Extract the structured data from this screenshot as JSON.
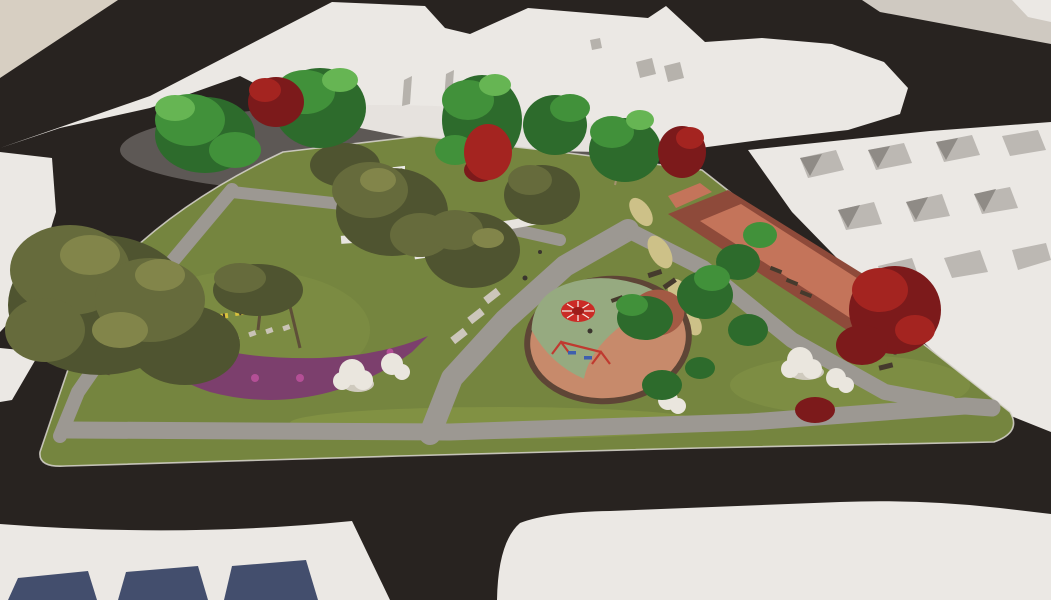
{
  "scene": {
    "type": "architectural-3d-render",
    "view": "aerial-perspective",
    "subject": "Triangular pocket park with circular playground, walkways, fitness track and planting, surrounded by dark asphalt streets, white plaza surfaces and white massing-model row houses",
    "features": [
      "asphalt-roads",
      "white-plazas",
      "beige-corner-lot",
      "row-house-block",
      "roof-courtyards",
      "blue-skylights",
      "park-lawn",
      "perimeter-walkway",
      "central-walkway",
      "circular-playground",
      "playground-carousel",
      "swing-set",
      "fitness-track",
      "ornamental-grass-bed",
      "purple-flower-crescent",
      "stepping-stones",
      "park-benches",
      "white-flowering-shrubs",
      "green-trees",
      "olive-trees",
      "red-maple-trees",
      "soccer-goal",
      "white-garden-walls",
      "pedestrians"
    ]
  },
  "colors": {
    "road": "#282320",
    "beige": "#d7cfc2",
    "plaza": "#ebe8e4",
    "plaza_shade": "#d9d4cf",
    "plaza_warm": "#cfc9c1",
    "furniture": "#b6b2ac",
    "roof_shadow": "#bcb8b3",
    "roof_dark": "#8f8b86",
    "skylight": "#434e6d",
    "grass": "#75853f",
    "grass_light": "#93a24c",
    "curb": "#d9d6cf",
    "path": "#9c9892",
    "track_dark": "#8e4a3a",
    "track_light": "#c4745a",
    "tallgrass": "#cdc188",
    "flower_purple": "#7c3f6d",
    "flower_magenta": "#b44f96",
    "stone": "#c9c3b6",
    "bench_yellow": "#d9c23c",
    "bench_light": "#ccc6bb",
    "bench_dark": "#453a2d",
    "pg_rim": "#5e4536",
    "pg_salmon": "#c78a6b",
    "pg_green": "#96aa80",
    "pg_rust": "#a35a44",
    "carousel_red": "#cb2b26",
    "carousel_dark": "#9e1d1a",
    "carousel_white": "#f2e9e2",
    "swing_red": "#c03a30",
    "swing_blue": "#3e5fae",
    "figure": "#3a352e",
    "wall_white": "#e7e4df",
    "goal_white": "#ecebe7",
    "shrub": "#eae6de",
    "shrub_shade": "#cfcabe",
    "olive_dark": "#4f5430",
    "olive_mid": "#666b3c",
    "olive_light": "#82854a",
    "green_dark": "#2d6b2c",
    "green_mid": "#41913a",
    "green_light": "#66b553",
    "red_dark": "#7c1a1b",
    "red_mid": "#a42420",
    "trunk": "#a3926f",
    "trunk_dark": "#5e4f38"
  }
}
